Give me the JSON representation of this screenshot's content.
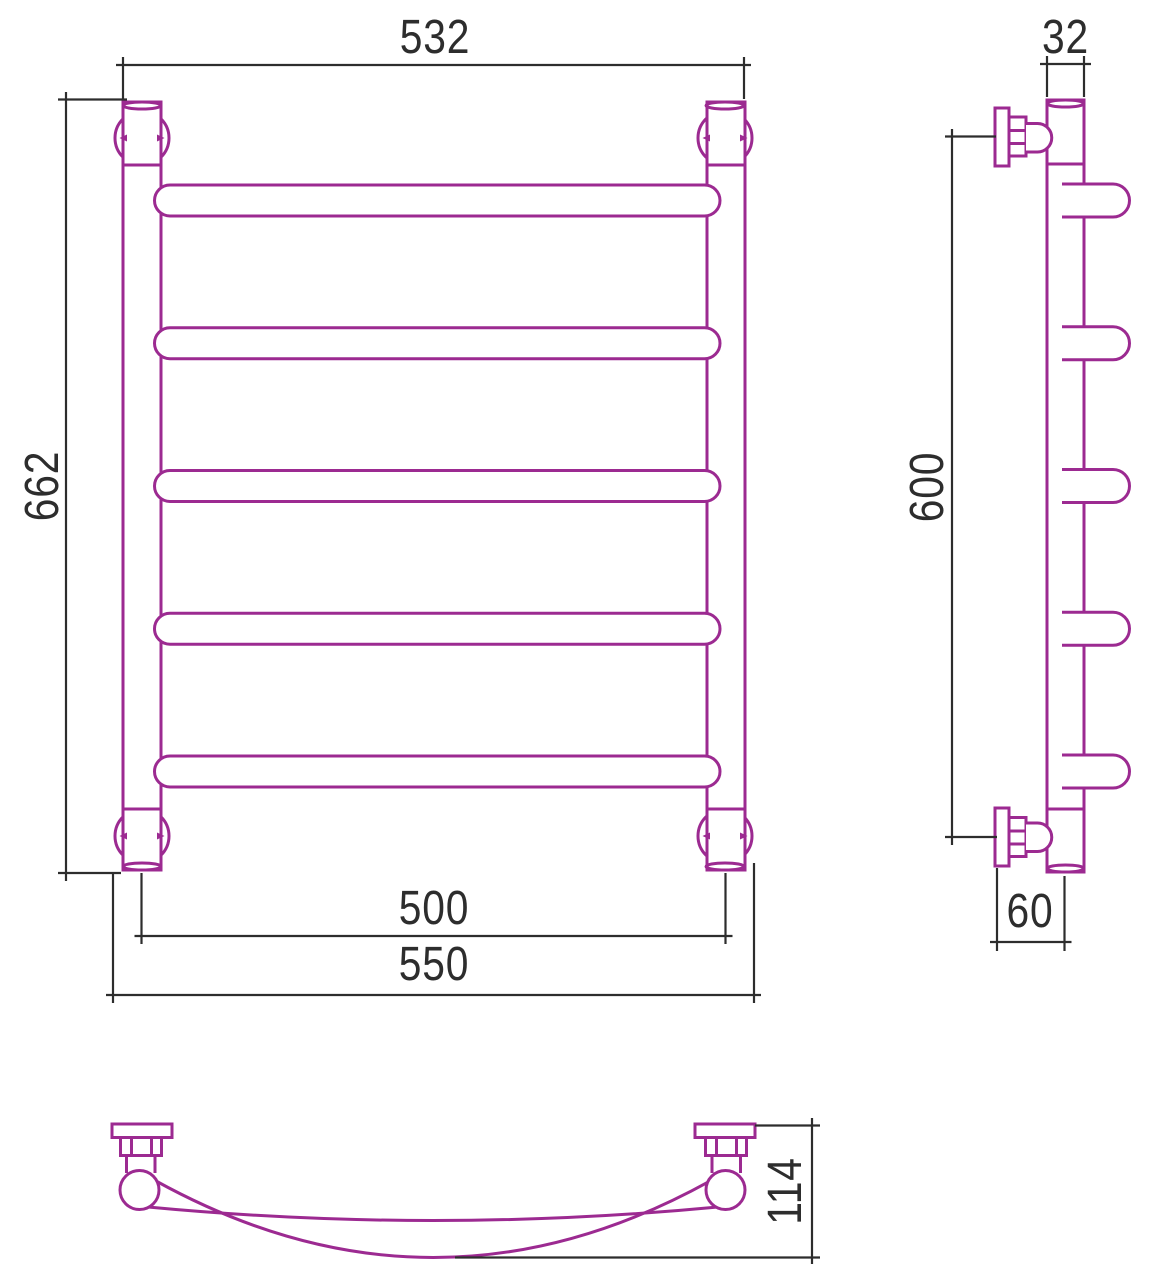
{
  "drawing": {
    "kind": "technical-drawing",
    "subject": "ladder heated towel rail, 5 curved bars, three orthographic views",
    "views": {
      "front": {
        "description": "front elevation with 4 wall brackets and 5 horizontal bars",
        "bars_count": 5,
        "dimensions_mm": {
          "top_width": "532",
          "overall_height": "662",
          "tube_axis_spacing": "500",
          "overall_width": "550"
        }
      },
      "side": {
        "description": "side elevation with two wall fasteners and bar stubs",
        "dimensions_mm": {
          "tube_diameter": "32",
          "bracket_spacing_height": "600",
          "wall_to_axis_offset": "60"
        }
      },
      "top": {
        "description": "plan view of one curved bar with two wall fasteners",
        "dimensions_mm": {
          "depth_from_wall": "114"
        }
      }
    }
  },
  "labels": {
    "dim_532": "532",
    "dim_662": "662",
    "dim_500": "500",
    "dim_550": "550",
    "dim_32": "32",
    "dim_600": "600",
    "dim_60": "60",
    "dim_114": "114"
  },
  "colors": {
    "product_outline": "#9c2a91",
    "dimension_lines": "#2d2d2d",
    "background": "#ffffff"
  }
}
